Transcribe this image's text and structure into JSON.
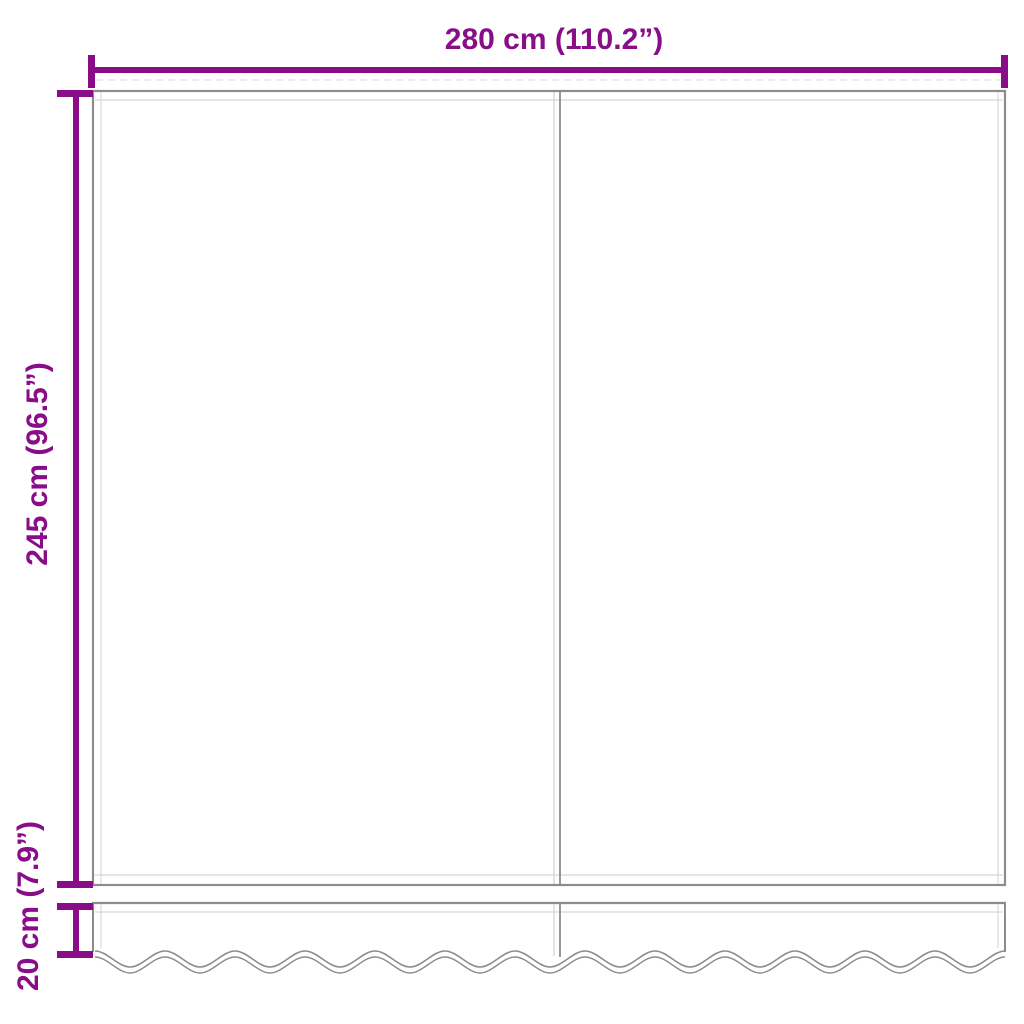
{
  "diagram": {
    "kind": "awning-fabric-dimension-diagram",
    "labels": {
      "width": "280 cm (110.2”)",
      "height": "245 cm (96.5”)",
      "valance": "20 cm (7.9”)"
    },
    "values": {
      "width_cm": 280,
      "width_inch": 110.2,
      "height_cm": 245,
      "height_inch": 96.5,
      "valance_height_cm": 20,
      "valance_height_inch": 7.9
    },
    "colors": {
      "dimension_accent": "#890d89",
      "fabric_outline": "#8c8c8c",
      "hem_line": "#d8d8d8",
      "background": "#ffffff"
    }
  }
}
